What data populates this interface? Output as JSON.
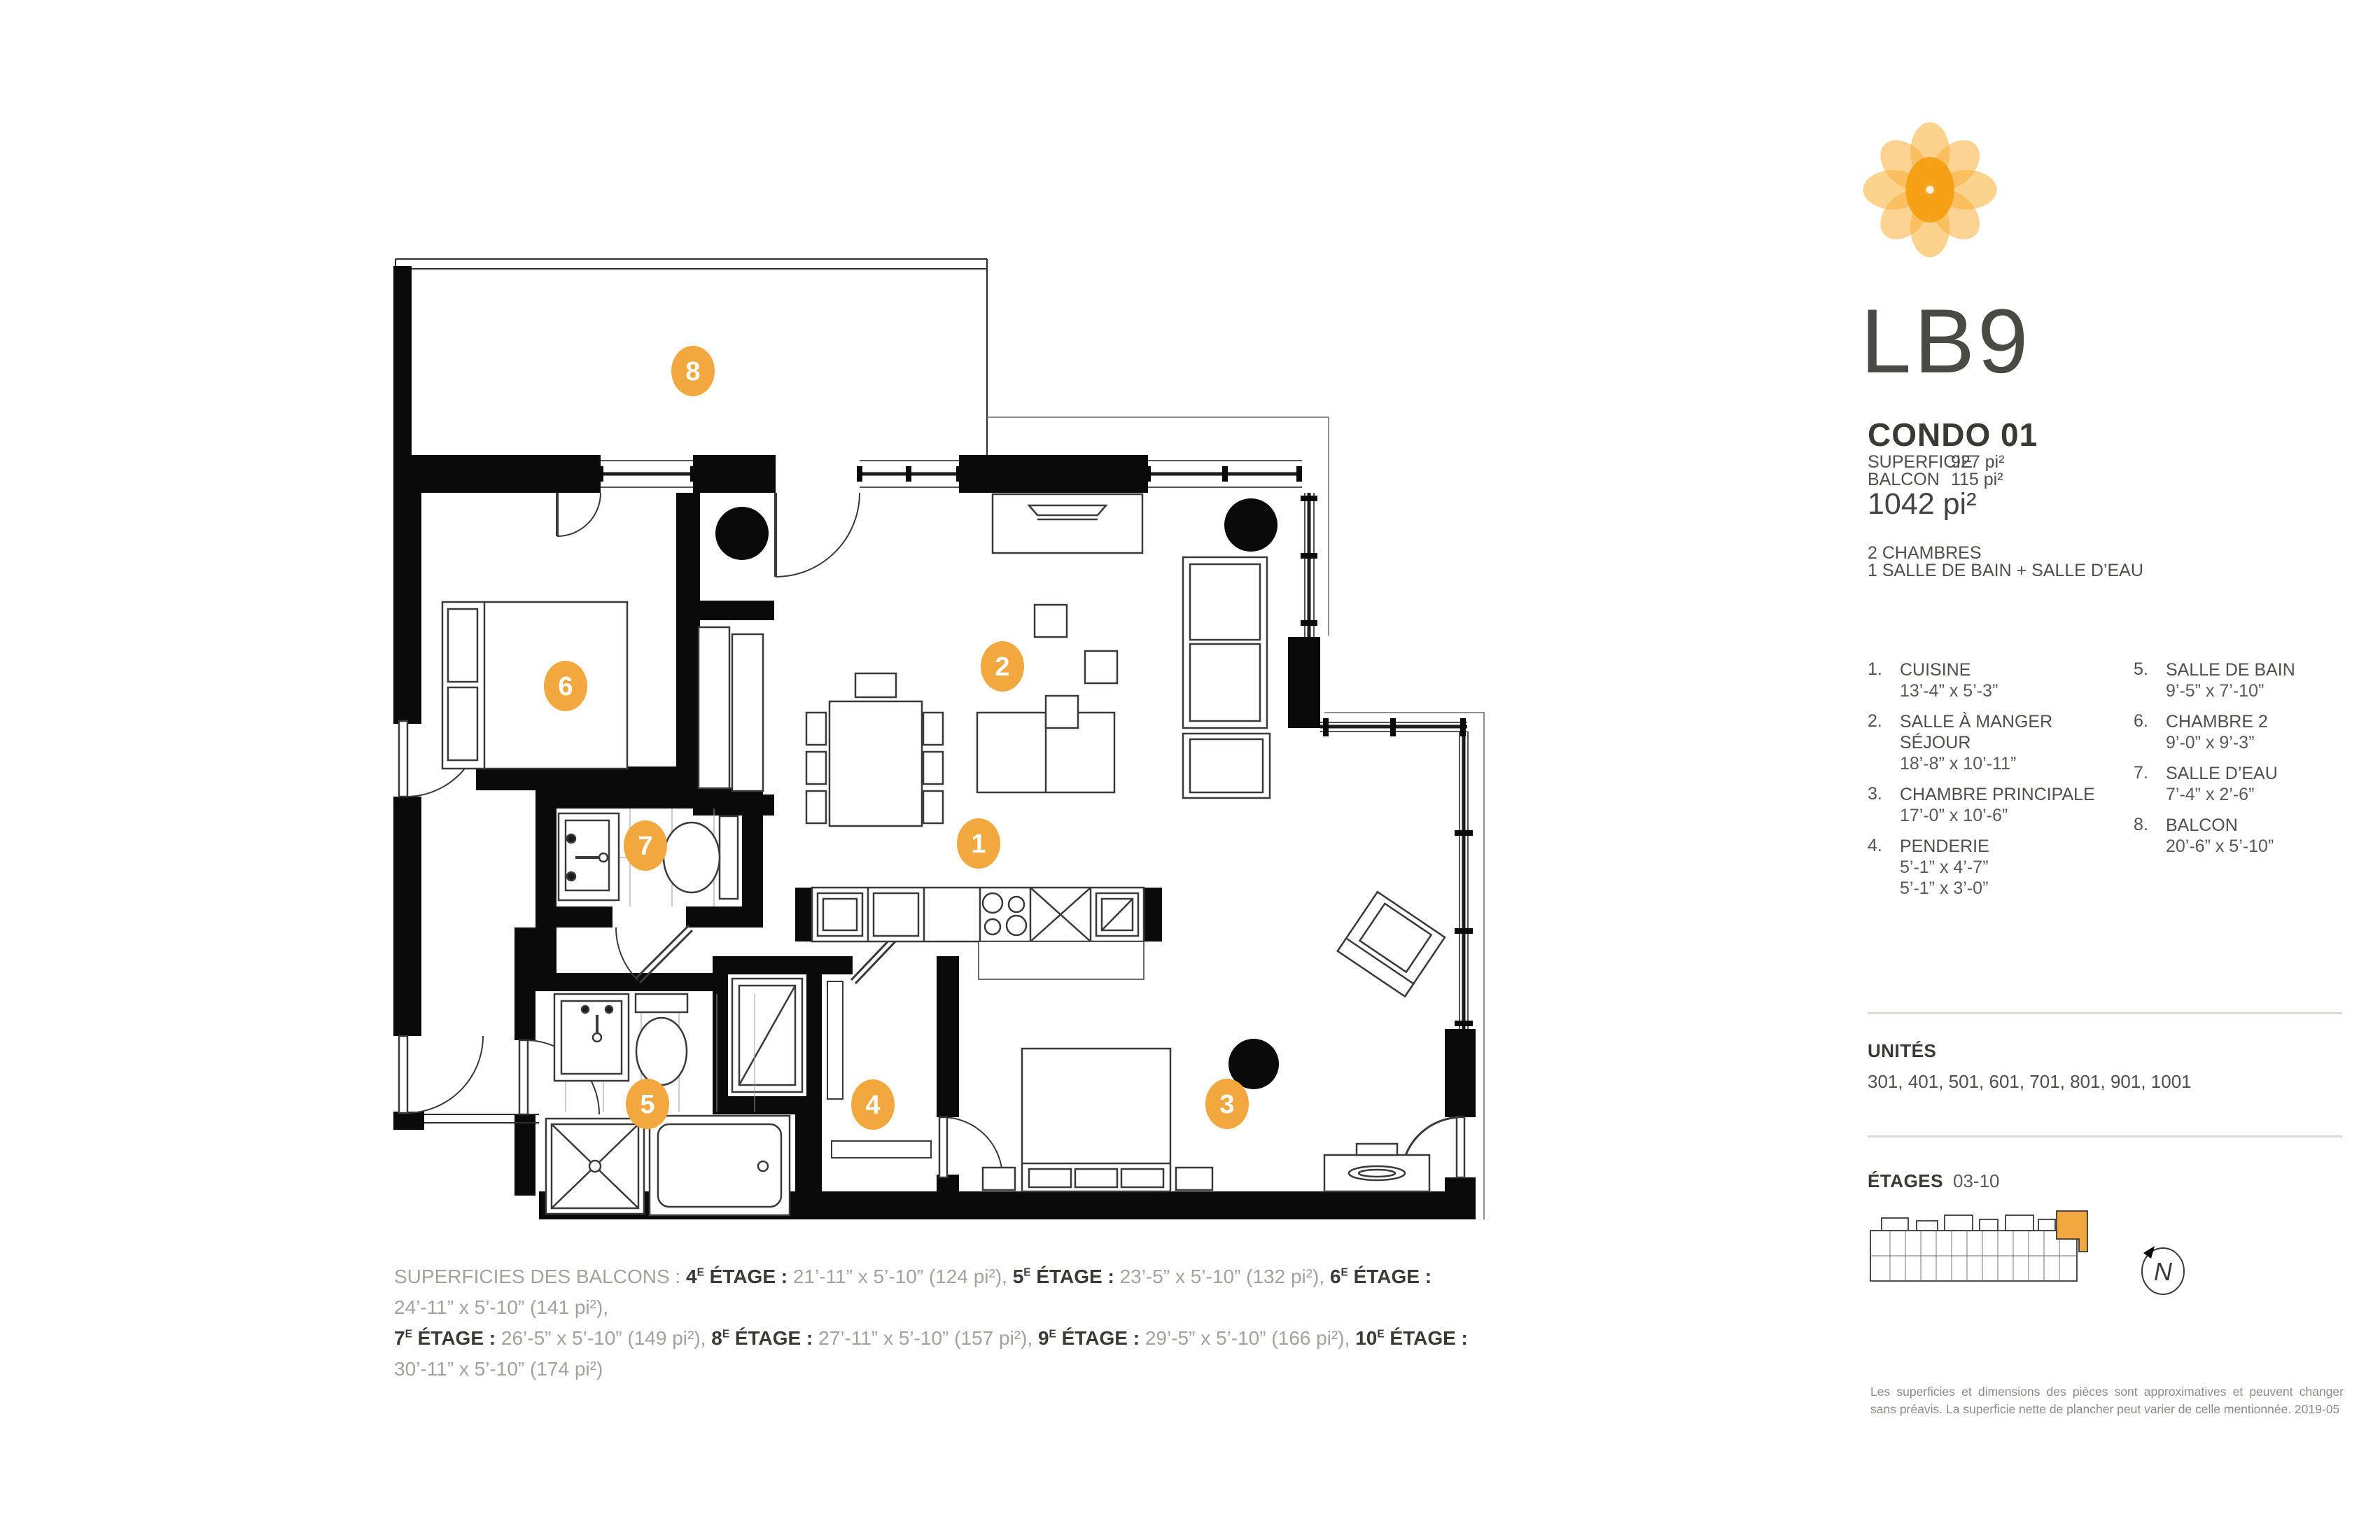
{
  "colors": {
    "accent": "#F3A73F",
    "wall": "#0A0A0A",
    "text_dark": "#3B3933",
    "text_gray": "#514F49",
    "text_light": "#A3A29B",
    "divider": "#DCDBD7"
  },
  "logo": {
    "brand": "LB9"
  },
  "condo": {
    "title": "CONDO 01",
    "superficie_label": "SUPERFICIE",
    "superficie_value": "927 pi²",
    "balcon_label": "BALCON",
    "balcon_value": "115 pi²",
    "total": "1042 pi²"
  },
  "program": {
    "line1": "2 CHAMBRES",
    "line2": "1 SALLE DE BAIN + SALLE D’EAU"
  },
  "rooms": [
    {
      "num": "1.",
      "name": "CUISINE",
      "dims1": "13’-4” x 5’-3”"
    },
    {
      "num": "2.",
      "name": "SALLE À MANGER",
      "name2": "SÉJOUR",
      "dims1": "18’-8” x 10’-11”"
    },
    {
      "num": "3.",
      "name": "CHAMBRE PRINCIPALE",
      "dims1": "17’-0” x 10’-6”"
    },
    {
      "num": "4.",
      "name": "PENDERIE",
      "dims1": "5’-1” x 4’-7”",
      "dims2": "5’-1” x 3’-0”"
    },
    {
      "num": "5.",
      "name": "SALLE DE BAIN",
      "dims1": "9’-5” x 7’-10”"
    },
    {
      "num": "6.",
      "name": "CHAMBRE 2",
      "dims1": "9’-0” x 9’-3”"
    },
    {
      "num": "7.",
      "name": "SALLE D’EAU",
      "dims1": "7’-4” x 2’-6”"
    },
    {
      "num": "8.",
      "name": "BALCON",
      "dims1": "20’-6” x 5’-10”"
    }
  ],
  "plan": {
    "markers": [
      "1",
      "2",
      "3",
      "4",
      "5",
      "6",
      "7",
      "8"
    ]
  },
  "unites": {
    "label": "UNITÉS",
    "values": "301, 401, 501, 601, 701, 801, 901, 1001"
  },
  "etages": {
    "label": "ÉTAGES",
    "range": "03-10"
  },
  "north": {
    "letter": "N"
  },
  "balconies": {
    "prefix": "SUPERFICIES DES BALCONS :",
    "entries": [
      {
        "floor": "4",
        "sup": "E",
        "label": "ÉTAGE :",
        "value": "21’-11” x 5’-10” (124 pi²),"
      },
      {
        "floor": "5",
        "sup": "E",
        "label": "ÉTAGE :",
        "value": "23’-5” x 5’-10” (132 pi²),"
      },
      {
        "floor": "6",
        "sup": "E",
        "label": "ÉTAGE :",
        "value": "24’-11” x 5’-10” (141 pi²),"
      },
      {
        "floor": "7",
        "sup": "E",
        "label": "ÉTAGE :",
        "value": "26’-5” x 5’-10” (149 pi²),"
      },
      {
        "floor": "8",
        "sup": "E",
        "label": "ÉTAGE :",
        "value": "27’-11” x 5’-10” (157 pi²),"
      },
      {
        "floor": "9",
        "sup": "E",
        "label": "ÉTAGE :",
        "value": "29’-5” x 5’-10” (166 pi²),"
      },
      {
        "floor": "10",
        "sup": "E",
        "label": "ÉTAGE :",
        "value": "30’-11” x 5’-10” (174 pi²)"
      }
    ]
  },
  "disclaimer": {
    "line1": "Les superficies et dimensions des pièces sont approximatives et peuvent changer",
    "line2": "sans préavis. La superficie nette de plancher peut varier de celle mentionnée. 2019-05"
  }
}
